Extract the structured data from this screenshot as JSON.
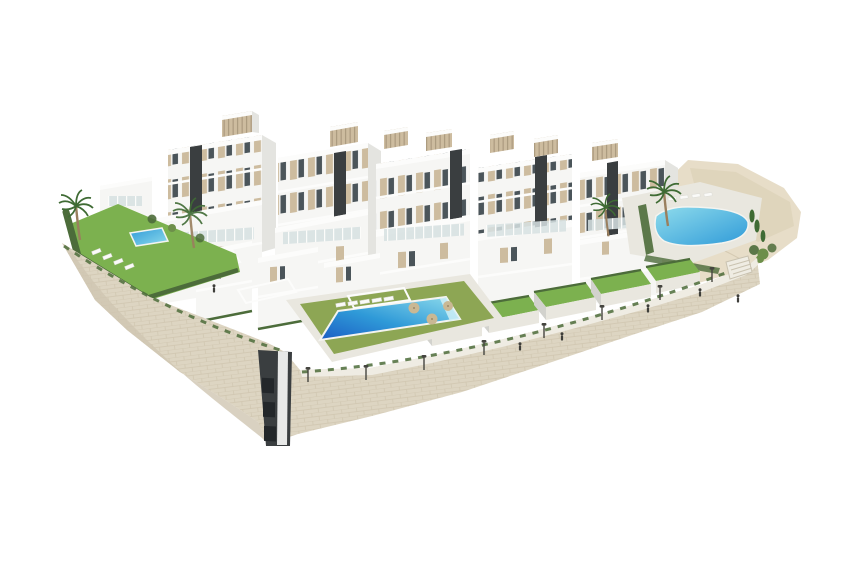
{
  "image": {
    "kind": "architectural-3d-render",
    "subject": "Aerial render of a white modern apartment complex on a stone podium wall with pools, lawns, palm trees and a sandy hillside",
    "background": "#ffffff"
  },
  "scene": {
    "pools_visible": 3,
    "palm_trees_visible": 4,
    "cars_visible": 1,
    "street_lamps_visible": 8,
    "people_visible": 6,
    "apartment_blocks_back_row": 5,
    "rooftop_bulkheads": 7,
    "private_gardens_right_row": 5
  },
  "colors": {
    "bg": "#ffffff",
    "building_white": "#f6f6f4",
    "building_shade": "#e4e4e0",
    "building_deep_shade": "#d2d2cd",
    "parapet": "#fcfcfb",
    "panel_beige": "#cdbc9f",
    "window_dark": "#4b555a",
    "core_dark": "#3a3e40",
    "glass_rail": "#d6e1e2",
    "lawn": "#7cb14f",
    "lawn_olive": "#8da654",
    "hedge": "#4c6c3a",
    "frond": "#3f6b34",
    "trunk": "#9a7f5e",
    "pool_deep": "#1b5ec4",
    "pool_mid": "#2f9ad8",
    "pool_light": "#8fdcec",
    "wall_stone": "#ddd5c2",
    "wall_joint": "#c3b89e",
    "wall_shade": "#cfc6b1",
    "walkway": "#efece3",
    "deck": "#e9e7df",
    "sand": "#e7ddc8",
    "sand_dark": "#d9cdb2",
    "umbrella": "#c9b894",
    "lounger": "#fafaf8",
    "metal": "#45453f",
    "person": "#3e3e3a",
    "car_body": "#f2f1ee",
    "car_glass": "#454b4e"
  }
}
